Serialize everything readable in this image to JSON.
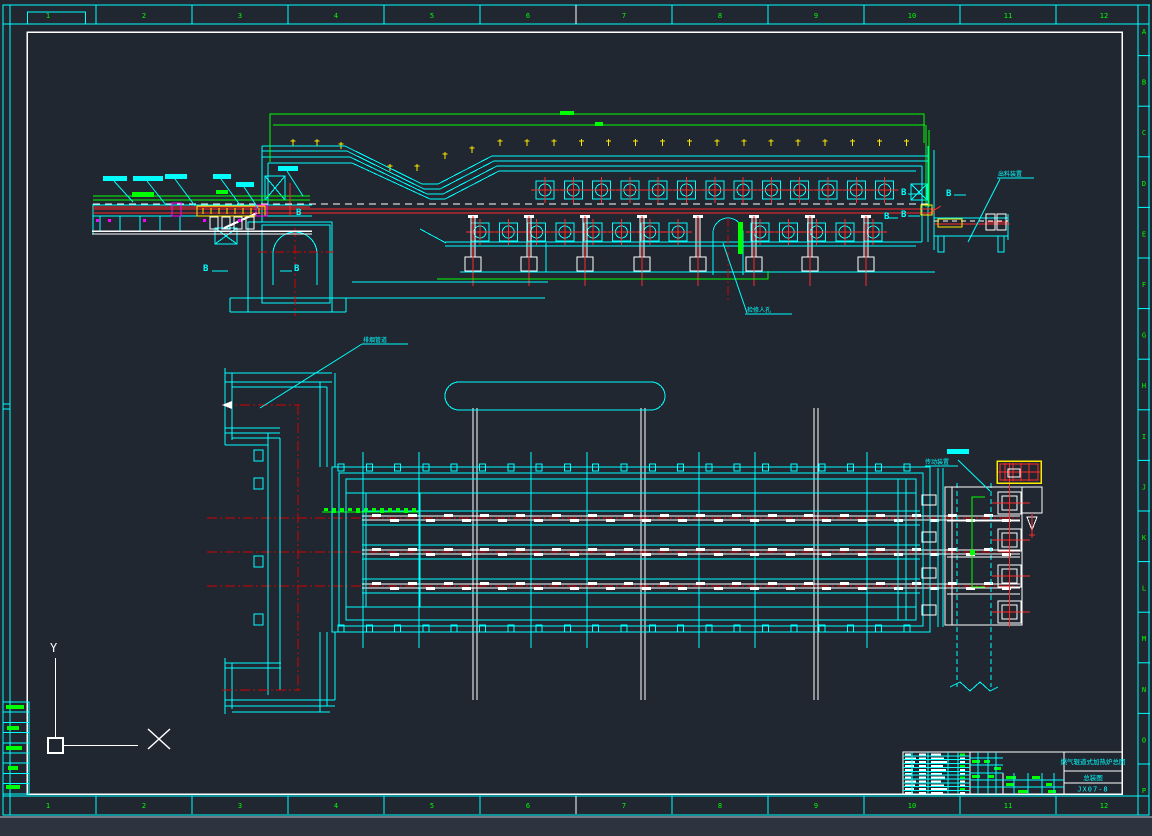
{
  "viewport": {
    "width": 1152,
    "height": 836,
    "background": "#212730",
    "bottom_strip": "#2d3440"
  },
  "palette": {
    "cyan": "#00ffff",
    "green": "#00ff00",
    "red": "#ff2a2a",
    "dark_red": "#d40000",
    "yellow": "#ffe800",
    "magenta": "#ff00ff",
    "white": "#ffffff"
  },
  "border": {
    "top_labels": [
      "1",
      "2",
      "3",
      "4",
      "5",
      "6",
      "7",
      "8",
      "9",
      "10",
      "11",
      "12"
    ],
    "bottom_labels": [
      "1",
      "2",
      "3",
      "4",
      "5",
      "6",
      "7",
      "8",
      "9",
      "10",
      "11",
      "12"
    ],
    "right_labels": [
      "A",
      "B",
      "C",
      "D",
      "E",
      "F",
      "G",
      "H",
      "I",
      "J",
      "K",
      "L",
      "M",
      "N",
      "O",
      "P"
    ],
    "label_color": "#00ff00"
  },
  "title_block": {
    "title": "燃气辊道式加热炉总图",
    "subtitle": "总装图",
    "drawing_no": "JX07-8"
  },
  "annotations": {
    "section_mark": "B",
    "ucs_y_label": "Y",
    "door_label": "检修人孔",
    "discharge_label": "出料装置",
    "flue_label": "排烟管道",
    "drive_label": "传动装置",
    "illegible_label_bars": 7
  },
  "tables": {
    "parts_list_rows": 11,
    "revision_rows": 9
  }
}
